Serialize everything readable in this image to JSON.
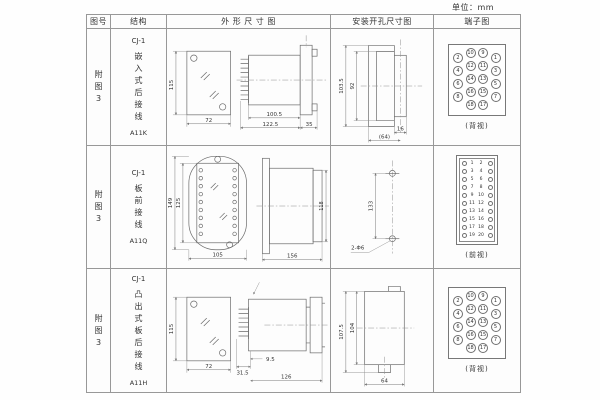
{
  "page": {
    "units": "单位：mm"
  },
  "headers": {
    "col1": "图号",
    "col2": "结构",
    "col3": "外 形 尺 寸 图",
    "col4": "安装开孔尺寸图",
    "col5": "端子图"
  },
  "rows": [
    {
      "fig": "附图3",
      "model": "CJ-1",
      "desc": "嵌入式后接线",
      "code": "A11K",
      "outline": {
        "front_h": "115",
        "front_w": "72",
        "side_d1": "100.5",
        "side_d2": "122.5",
        "side_d3": "35"
      },
      "install": {
        "v1": "103.5",
        "v2": "92",
        "h1": "16",
        "h2": "(64)"
      },
      "terminal": {
        "caption": "(背视)",
        "r": 5,
        "fs": 5,
        "items": [
          {
            "x": 9,
            "y": 13,
            "n": "2"
          },
          {
            "x": 9,
            "y": 26,
            "n": "4"
          },
          {
            "x": 9,
            "y": 39,
            "n": "6"
          },
          {
            "x": 9,
            "y": 52,
            "n": "8"
          },
          {
            "x": 21.5,
            "y": 8,
            "n": "10"
          },
          {
            "x": 21.5,
            "y": 21,
            "n": "12"
          },
          {
            "x": 21.5,
            "y": 34,
            "n": "14"
          },
          {
            "x": 21.5,
            "y": 47,
            "n": "16"
          },
          {
            "x": 21.5,
            "y": 60,
            "n": "18"
          },
          {
            "x": 34,
            "y": 8,
            "n": "9"
          },
          {
            "x": 34,
            "y": 21,
            "n": "11"
          },
          {
            "x": 34,
            "y": 34,
            "n": "13"
          },
          {
            "x": 34,
            "y": 47,
            "n": "15"
          },
          {
            "x": 34,
            "y": 60,
            "n": "17"
          },
          {
            "x": 46.5,
            "y": 13,
            "n": "1"
          },
          {
            "x": 46.5,
            "y": 26,
            "n": "3"
          },
          {
            "x": 46.5,
            "y": 39,
            "n": "5"
          },
          {
            "x": 46.5,
            "y": 52,
            "n": "7"
          }
        ]
      }
    },
    {
      "fig": "附图3",
      "model": "CJ-1",
      "desc": "板前接线",
      "code": "A11Q",
      "outline": {
        "front_h1": "149",
        "front_h2": "125",
        "front_w": "105",
        "side_l": "156",
        "side_h": "118"
      },
      "install": {
        "v1": "133",
        "hole": "2-Φ6"
      },
      "terminal": {
        "caption": "(前视)",
        "r": 2.5,
        "fs": 4.5,
        "items": [
          {
            "x": 7,
            "y": 8,
            "c": 1
          },
          {
            "x": 15,
            "y": 8,
            "n": "1",
            "t": 1
          },
          {
            "x": 24,
            "y": 8,
            "n": "2",
            "t": 1
          },
          {
            "x": 33,
            "y": 8,
            "c": 1
          },
          {
            "x": 7,
            "y": 16,
            "c": 1
          },
          {
            "x": 15,
            "y": 16,
            "n": "3",
            "t": 1
          },
          {
            "x": 24,
            "y": 16,
            "n": "4",
            "t": 1
          },
          {
            "x": 33,
            "y": 16,
            "c": 1
          },
          {
            "x": 7,
            "y": 24,
            "c": 1
          },
          {
            "x": 15,
            "y": 24,
            "n": "5",
            "t": 1
          },
          {
            "x": 24,
            "y": 24,
            "n": "6",
            "t": 1
          },
          {
            "x": 33,
            "y": 24,
            "c": 1
          },
          {
            "x": 7,
            "y": 32,
            "c": 1
          },
          {
            "x": 15,
            "y": 32,
            "n": "7",
            "t": 1
          },
          {
            "x": 24,
            "y": 32,
            "n": "8",
            "t": 1
          },
          {
            "x": 33,
            "y": 32,
            "c": 1
          },
          {
            "x": 7,
            "y": 40,
            "c": 1
          },
          {
            "x": 15,
            "y": 40,
            "n": "9",
            "t": 1
          },
          {
            "x": 24,
            "y": 40,
            "n": "10",
            "t": 1
          },
          {
            "x": 33,
            "y": 40,
            "c": 1
          },
          {
            "x": 7,
            "y": 48,
            "c": 1
          },
          {
            "x": 15,
            "y": 48,
            "n": "11",
            "t": 1
          },
          {
            "x": 24,
            "y": 48,
            "n": "12",
            "t": 1
          },
          {
            "x": 33,
            "y": 48,
            "c": 1
          },
          {
            "x": 7,
            "y": 56,
            "c": 1
          },
          {
            "x": 15,
            "y": 56,
            "n": "13",
            "t": 1
          },
          {
            "x": 24,
            "y": 56,
            "n": "14",
            "t": 1
          },
          {
            "x": 33,
            "y": 56,
            "c": 1
          },
          {
            "x": 7,
            "y": 64,
            "c": 1
          },
          {
            "x": 15,
            "y": 64,
            "n": "15",
            "t": 1
          },
          {
            "x": 24,
            "y": 64,
            "n": "16",
            "t": 1
          },
          {
            "x": 33,
            "y": 64,
            "c": 1
          },
          {
            "x": 7,
            "y": 72,
            "c": 1
          },
          {
            "x": 15,
            "y": 72,
            "n": "17",
            "t": 1
          },
          {
            "x": 24,
            "y": 72,
            "n": "18",
            "t": 1
          },
          {
            "x": 33,
            "y": 72,
            "c": 1
          },
          {
            "x": 7,
            "y": 80,
            "c": 1
          },
          {
            "x": 15,
            "y": 80,
            "n": "19",
            "t": 1
          },
          {
            "x": 24,
            "y": 80,
            "n": "20",
            "t": 1
          },
          {
            "x": 33,
            "y": 80,
            "c": 1
          }
        ]
      }
    },
    {
      "fig": "附图3",
      "model": "CJ-1",
      "desc": "凸出式板后接线",
      "code": "A11H",
      "outline": {
        "front_h": "115",
        "front_w": "72",
        "side_d1": "31.5",
        "side_d2": "9.5",
        "side_d3": "126"
      },
      "install": {
        "v1": "107.5",
        "v2": "104",
        "h1": "64"
      },
      "terminal": {
        "caption": "(背视)",
        "r": 5,
        "fs": 5,
        "items": [
          {
            "x": 9,
            "y": 13,
            "n": "2"
          },
          {
            "x": 9,
            "y": 26,
            "n": "4"
          },
          {
            "x": 9,
            "y": 39,
            "n": "6"
          },
          {
            "x": 9,
            "y": 52,
            "n": "8"
          },
          {
            "x": 21.5,
            "y": 8,
            "n": "10"
          },
          {
            "x": 21.5,
            "y": 21,
            "n": "12"
          },
          {
            "x": 21.5,
            "y": 34,
            "n": "14"
          },
          {
            "x": 21.5,
            "y": 47,
            "n": "16"
          },
          {
            "x": 21.5,
            "y": 60,
            "n": "18"
          },
          {
            "x": 34,
            "y": 8,
            "n": "9"
          },
          {
            "x": 34,
            "y": 21,
            "n": "11"
          },
          {
            "x": 34,
            "y": 34,
            "n": "13"
          },
          {
            "x": 34,
            "y": 47,
            "n": "15"
          },
          {
            "x": 34,
            "y": 60,
            "n": "17"
          },
          {
            "x": 46.5,
            "y": 13,
            "n": "1"
          },
          {
            "x": 46.5,
            "y": 26,
            "n": "3"
          },
          {
            "x": 46.5,
            "y": 39,
            "n": "5"
          },
          {
            "x": 46.5,
            "y": 52,
            "n": "7"
          }
        ]
      }
    }
  ]
}
